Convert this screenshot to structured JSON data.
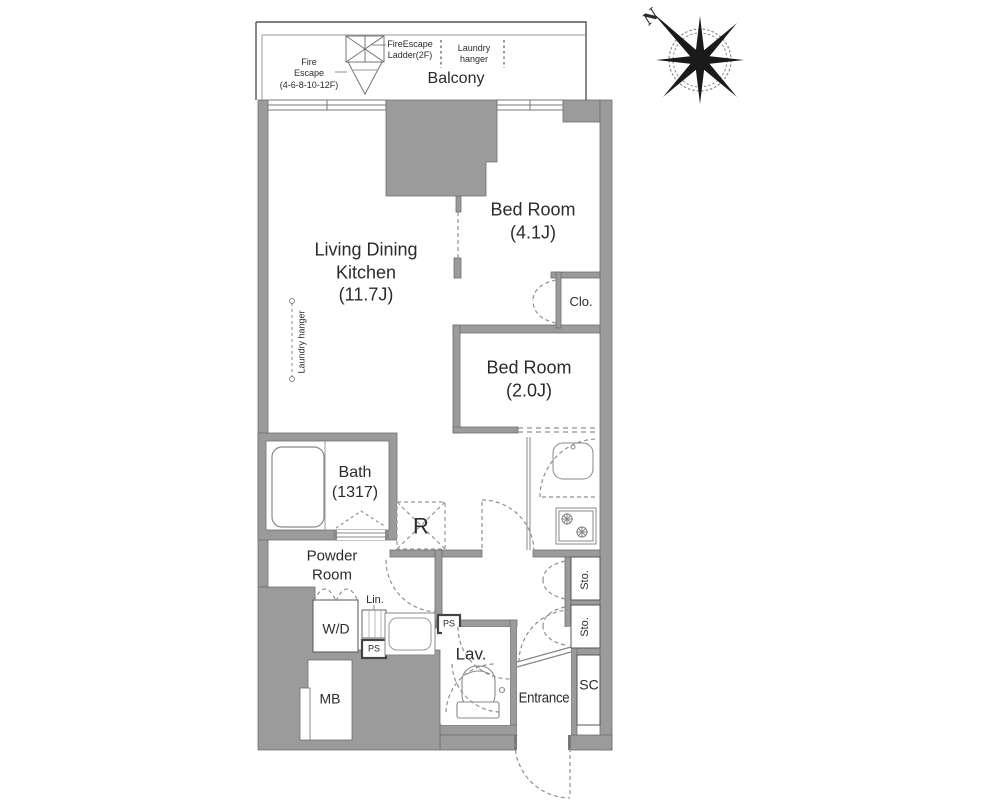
{
  "colors": {
    "wall": "#9b9b9b",
    "wall_edge": "#6f6f6f",
    "line": "#777777",
    "dash": "#909090",
    "text": "#2b2b2b"
  },
  "compass": {
    "north": "N"
  },
  "balcony": {
    "label": "Balcony",
    "fire_escape": "Fire\nEscape\n(4-6-8-10-12F)",
    "fire_escape_ladder": "FireEscape\nLadder(2F)",
    "laundry_hanger": "Laundry\nhanger"
  },
  "rooms": {
    "living": "Living Dining\nKitchen\n(11.7J)",
    "bedroom1": "Bed Room\n(4.1J)",
    "bedroom2": "Bed Room\n(2.0J)",
    "bath": "Bath\n(1317)",
    "powder_room": "Powder\nRoom",
    "lavatory": "Lav.",
    "entrance": "Entrance"
  },
  "fixtures": {
    "closet": "Clo.",
    "refrigerator": "R",
    "washer_dryer": "W/D",
    "linen": "Lin.",
    "pipe_space": "PS",
    "shoe_closet": "SC",
    "storage": "Sto.",
    "meter_box": "MB",
    "laundry_hanger": "Laundry hanger"
  }
}
